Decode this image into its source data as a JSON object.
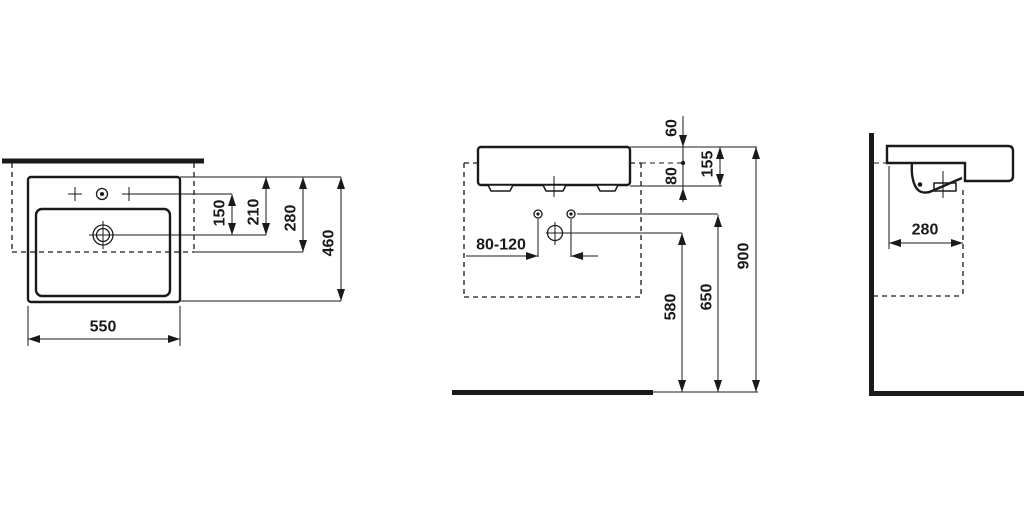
{
  "colors": {
    "line": "#1a1a1a",
    "background": "#ffffff"
  },
  "drawing": {
    "views": {
      "top": {
        "d550": "550",
        "d460": "460",
        "d280": "280",
        "d210": "210",
        "d150": "150"
      },
      "front": {
        "d60": "60",
        "d80": "80",
        "d155": "155",
        "d80_120": "80-120",
        "d580": "580",
        "d650": "650",
        "d900": "900"
      },
      "side": {
        "d280": "280"
      }
    }
  }
}
